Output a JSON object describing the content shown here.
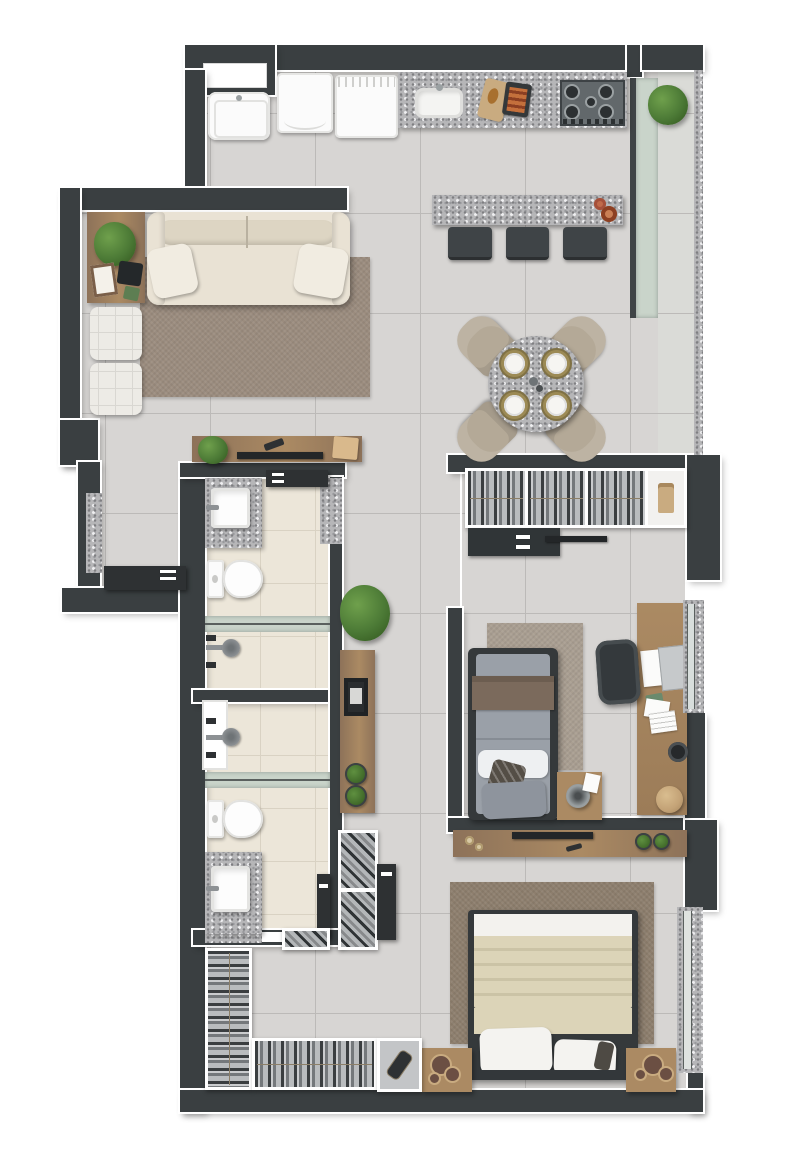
{
  "meta": {
    "title": "Apartment floor plan – furnished top-down 3D render",
    "style": "architectural marketing render, no text labels visible"
  },
  "colors": {
    "wall": "#3a3f41",
    "outline": "#ffffff",
    "floor": "#d7d5d3",
    "grout": "#bcbab8",
    "balcony_floor": "#dadbd7",
    "bath_floor": "#ece6d9",
    "bath_grout": "#d9d2c3",
    "granite_base": "#b6b6b8",
    "granite_dark": "#7f7f82",
    "granite_light": "#efeff1",
    "wood": "#8d7259",
    "wood_light": "#ab8a63",
    "appliance": "#fbfbfb",
    "steel": "#565c60",
    "burner": "#2c3032",
    "glass": "#c9d4ca",
    "glass_line": "#5a605e",
    "plant": "#4c7a36",
    "plant_dark": "#33591f",
    "sofa": "#e9e2d4",
    "sofa_shade": "#ddd5c3",
    "pillow": "#f1ece1",
    "rug_living": "#9b8c7e",
    "rug_bed1": "#a99e91",
    "rug_master": "#8d7e6d",
    "pouf_white": "#edebe6",
    "stool": "#3f4447",
    "chair": "#b4a997",
    "gold": "#9c8a55",
    "plate": "#f6f5f2",
    "mattress": "#9aa0a8",
    "bed_gray": "#8e949d",
    "throw": "#7b6a5c",
    "accent_dark": "#544e46",
    "blanket": "#dcd4b8",
    "blanket_shade": "#cbc3a6",
    "sheet": "#f3f2ee",
    "frame_dark": "#35393b",
    "terracotta": "#c06a4a",
    "tan": "#c9ab80",
    "item_dark": "#2e3133",
    "lamp": "#9aa0a2",
    "tv": "#232628"
  },
  "scene": {
    "type": "apartment-floor-plan",
    "view": "top-down",
    "rooms": [
      {
        "name": "kitchen",
        "furniture": [
          "laundry-sink",
          "washing-machine",
          "dishwasher",
          "granite-countertop",
          "kitchen-sink",
          "cutting-board",
          "grill-pan",
          "cooktop",
          "breakfast-bar",
          "bar-stool",
          "bar-stool",
          "bar-stool",
          "flower-pots"
        ]
      },
      {
        "name": "balcony",
        "furniture": [
          "glass-partition",
          "granite-railing",
          "planter-shrub"
        ]
      },
      {
        "name": "living-room",
        "furniture": [
          "side-table",
          "potted-plant",
          "picture-frame",
          "tablet",
          "sofa",
          "throw-pillow",
          "throw-pillow",
          "area-rug",
          "ottoman",
          "ottoman",
          "tv-console",
          "tv",
          "console-plant",
          "storage-box",
          "remote"
        ]
      },
      {
        "name": "dining-area",
        "furniture": [
          "round-granite-table",
          "dining-chair",
          "dining-chair",
          "dining-chair",
          "dining-chair",
          "place-setting",
          "place-setting",
          "place-setting",
          "place-setting"
        ]
      },
      {
        "name": "entry",
        "furniture": [
          "entry-door",
          "granite-window-sill"
        ]
      },
      {
        "name": "bathroom-1",
        "furniture": [
          "granite-vanity",
          "square-sink",
          "toilet",
          "shower-glass-screen",
          "shower-head",
          "shower-controls",
          "door",
          "granite-niche"
        ]
      },
      {
        "name": "bathroom-2",
        "furniture": [
          "shower-glass-panel",
          "shower-head",
          "shower-controls",
          "shower-glass-screen",
          "toilet",
          "granite-vanity",
          "square-sink",
          "door"
        ]
      },
      {
        "name": "hallway",
        "furniture": [
          "floor-plant",
          "wall-console",
          "framed-art",
          "potted-plant",
          "potted-plant",
          "shoe-rack",
          "shoe-cubby",
          "master-door"
        ]
      },
      {
        "name": "bedroom-1",
        "furniture": [
          "wardrobe-hanging-clothes",
          "folded-shirt-shelf",
          "drawer-chest",
          "tv",
          "single-bed",
          "throw-blanket",
          "pillows",
          "area-rug",
          "nightstand",
          "table-lamp",
          "desk",
          "laptop",
          "papers",
          "desk-chair",
          "pouf",
          "window"
        ]
      },
      {
        "name": "master-bedroom",
        "furniture": [
          "media-sideboard",
          "tv",
          "candles",
          "potted-plant",
          "potted-plant",
          "double-bed",
          "cream-duvet",
          "pillows",
          "area-rug",
          "nightstand",
          "nightstand",
          "decor-bowls",
          "window"
        ]
      },
      {
        "name": "walk-in-closet",
        "furniture": [
          "clothes-rack-vertical",
          "clothes-rack-horizontal",
          "accessory-cubby"
        ]
      }
    ],
    "openings": [
      "top-wall-window",
      "entry-door-left",
      "balcony-glass-front",
      "bedroom-1-window",
      "master-bedroom-window",
      "bathroom-2-glass-panel"
    ]
  }
}
